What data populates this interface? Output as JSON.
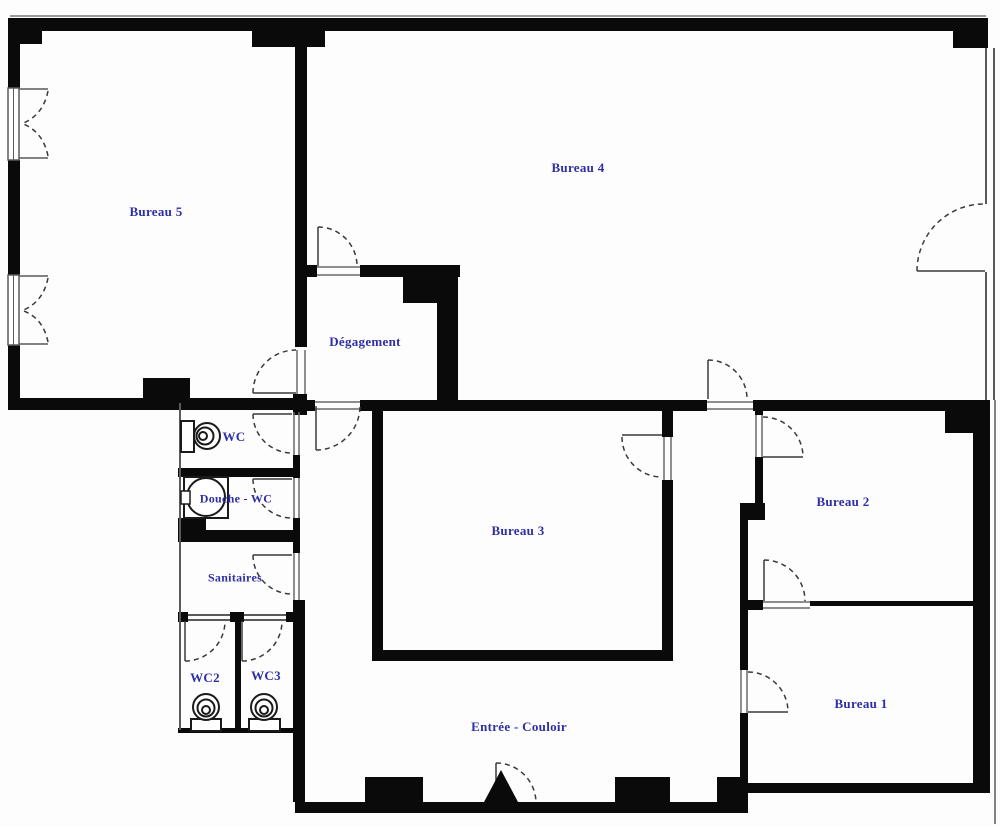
{
  "plan": {
    "type": "architectural-floor-plan",
    "language": "French"
  },
  "colors": {
    "wall": "#0a0a0a",
    "label": "#2e2ea6",
    "thin_line": "#5a5a5a",
    "door_arc": "#3a3a3a",
    "background": "#fdfdfd"
  },
  "rooms": [
    {
      "id": "bureau-5",
      "label": "Bureau 5"
    },
    {
      "id": "bureau-4",
      "label": "Bureau 4"
    },
    {
      "id": "degagement",
      "label": "Dégagement"
    },
    {
      "id": "wc",
      "label": "WC"
    },
    {
      "id": "douche-wc",
      "label": "Douche - WC"
    },
    {
      "id": "sanitaires",
      "label": "Sanitaires"
    },
    {
      "id": "wc2",
      "label": "WC2"
    },
    {
      "id": "wc3",
      "label": "WC3"
    },
    {
      "id": "bureau-3",
      "label": "Bureau 3"
    },
    {
      "id": "bureau-2",
      "label": "Bureau 2"
    },
    {
      "id": "bureau-1",
      "label": "Bureau 1"
    },
    {
      "id": "entree-couloir",
      "label": "Entrée - Couloir"
    }
  ],
  "fixtures": [
    {
      "id": "wc-toilet",
      "icon": "toilet-icon",
      "room": "WC"
    },
    {
      "id": "douche-shower",
      "icon": "shower-tray-icon",
      "room": "Douche - WC"
    },
    {
      "id": "wc2-toilet",
      "icon": "toilet-icon",
      "room": "WC2"
    },
    {
      "id": "wc3-toilet",
      "icon": "toilet-icon",
      "room": "WC3"
    },
    {
      "id": "entrance-mark",
      "icon": "entrance-arrow-icon",
      "room": "Entrée - Couloir"
    }
  ],
  "symbols": {
    "door_swing": "dashed-quarter-arc",
    "window": "double-line-with-casement-arcs"
  }
}
